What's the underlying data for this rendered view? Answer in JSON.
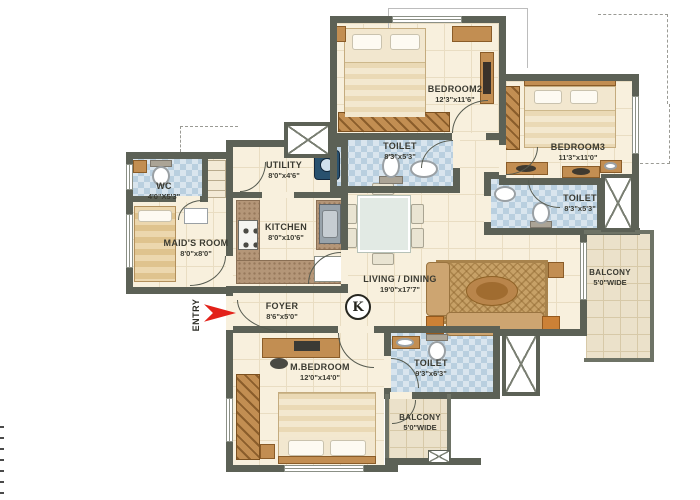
{
  "plan": {
    "title": "apartment-floor-plan",
    "rooms": {
      "bedroom2": {
        "name": "BEDROOM2",
        "dims": "12'3\"x11'6\""
      },
      "toilet_top": {
        "name": "TOILET",
        "dims": "8'3\"x5'3\""
      },
      "bedroom3": {
        "name": "BEDROOM3",
        "dims": "11'3\"x11'0\""
      },
      "toilet_right": {
        "name": "TOILET",
        "dims": "8'3\"x5'3\""
      },
      "wc": {
        "name": "WC",
        "dims": "4'0\"X5'3\""
      },
      "maids_room": {
        "name": "MAID'S ROOM",
        "dims": "8'0\"x8'0\""
      },
      "utility": {
        "name": "UTILITY",
        "dims": "8'0\"x4'6\""
      },
      "kitchen": {
        "name": "KITCHEN",
        "dims": "8'0\"x10'6\""
      },
      "living_dining": {
        "name": "LIVING / DINING",
        "dims": "19'0\"x17'7\""
      },
      "foyer": {
        "name": "FOYER",
        "dims": "8'6\"x5'0\""
      },
      "master_bedroom": {
        "name": "M.BEDROOM",
        "dims": "12'0\"x14'0\""
      },
      "toilet_master": {
        "name": "TOILET",
        "dims": "9'3\"x6'3\""
      },
      "balcony_right": {
        "name": "BALCONY",
        "dims": "5'0\"WIDE"
      },
      "balcony_bottom": {
        "name": "BALCONY",
        "dims": "5'0\"WIDE"
      }
    },
    "entry_label": "ENTRY",
    "compass_label": "K",
    "colors": {
      "wall": "#5c6156",
      "floor": "#f8f0dd",
      "bath_tile": "#d9e5ee",
      "balcony_tile": "#ebe1ca",
      "wood": "#c28e52",
      "entry_arrow": "#e32119"
    }
  }
}
